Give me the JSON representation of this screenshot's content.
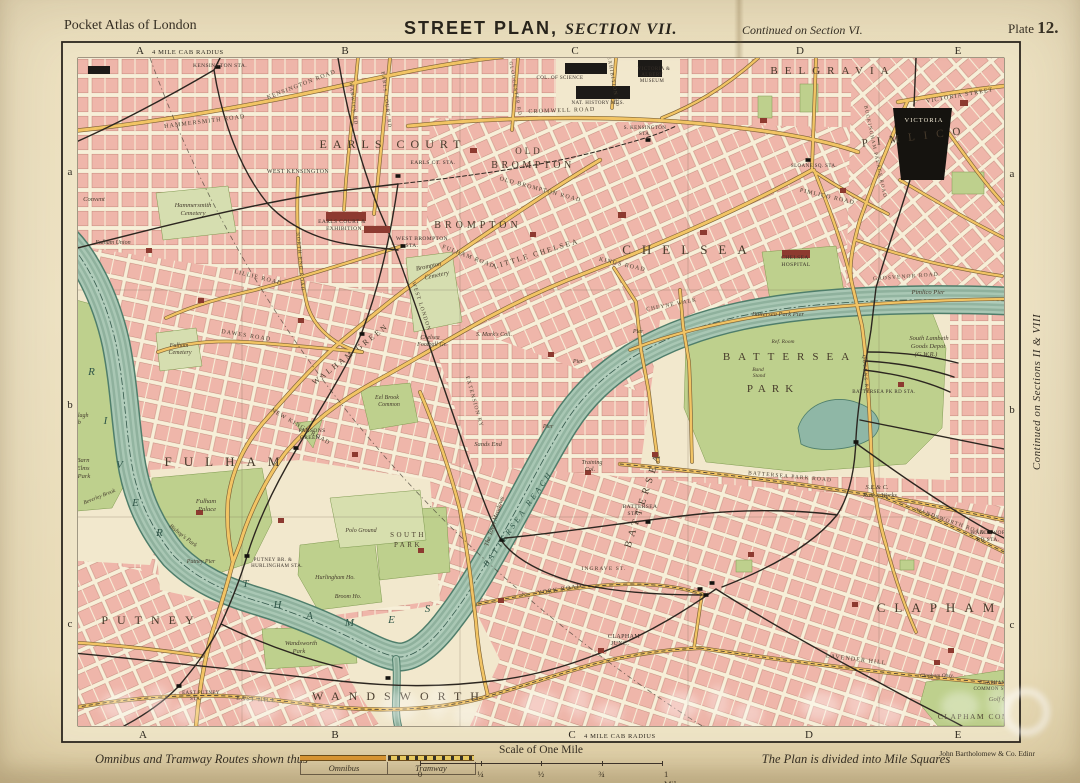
{
  "header": {
    "left": "Pocket Atlas of London",
    "title": "STREET PLAN,",
    "section": "SECTION VII.",
    "continued": "Continued on Section VI.",
    "plate_word": "Plate",
    "plate_num": "12."
  },
  "margins": {
    "cab_top": "4 MILE CAB RADIUS",
    "cab_bottom": "4 MILE CAB RADIUS",
    "top": [
      {
        "t": "A",
        "x": 140
      },
      {
        "t": "B",
        "x": 345
      },
      {
        "t": "C",
        "x": 575
      },
      {
        "t": "D",
        "x": 800
      },
      {
        "t": "E",
        "x": 958
      }
    ],
    "bottom": [
      {
        "t": "A",
        "x": 143
      },
      {
        "t": "B",
        "x": 335
      },
      {
        "t": "C",
        "x": 572
      },
      {
        "t": "D",
        "x": 809
      },
      {
        "t": "E",
        "x": 958
      }
    ],
    "left": [
      {
        "t": "a",
        "y": 175
      },
      {
        "t": "b",
        "y": 408
      },
      {
        "t": "c",
        "y": 627
      }
    ],
    "right": [
      {
        "t": "a",
        "y": 177
      },
      {
        "t": "b",
        "y": 413
      },
      {
        "t": "c",
        "y": 628
      }
    ],
    "right_note": "Continued on Sections II & VIII"
  },
  "footer": {
    "routes": "Omnibus and Tramway Routes shown thus",
    "omnibus": "Omnibus",
    "tramway": "Tramway",
    "scale_title": "Scale of One Mile",
    "ticks": [
      "0",
      "¼",
      "½",
      "¾",
      "1 Mile"
    ],
    "note": "The Plan is divided into Mile Squares",
    "publisher": "John Bartholomew & Co. Edinr"
  },
  "map": {
    "labels": [
      {
        "t": "EARLS COURT",
        "x": 393,
        "y": 148,
        "c": "d2",
        "s": 12,
        "ls": 6
      },
      {
        "t": "OLD",
        "x": 529,
        "y": 154,
        "c": "d2",
        "s": 9,
        "ls": 3
      },
      {
        "t": "BROMPTON",
        "x": 533,
        "y": 168,
        "c": "d2",
        "s": 10,
        "ls": 3.5
      },
      {
        "t": "BROMPTON",
        "x": 478,
        "y": 228,
        "c": "d2",
        "s": 10,
        "ls": 4
      },
      {
        "t": "LITTLE CHELSEA",
        "x": 537,
        "y": 256,
        "c": "d3",
        "r": -17,
        "s": 7.5,
        "ls": 2
      },
      {
        "t": "CHELSEA",
        "x": 690,
        "y": 254,
        "c": "d1",
        "s": 13,
        "ls": 11
      },
      {
        "t": "BELGRAVIA",
        "x": 833,
        "y": 74,
        "c": "d2",
        "s": 11,
        "ls": 7
      },
      {
        "t": "PIMLICO",
        "x": 916,
        "y": 140,
        "c": "d2",
        "r": -7,
        "s": 11,
        "ls": 9
      },
      {
        "t": "WALHAM GREEN",
        "x": 352,
        "y": 356,
        "c": "d3",
        "r": -38,
        "s": 8,
        "ls": 2.5
      },
      {
        "t": "FULHAM",
        "x": 228,
        "y": 466,
        "c": "d1",
        "s": 13,
        "ls": 12
      },
      {
        "t": "PUTNEY",
        "x": 152,
        "y": 624,
        "c": "d1",
        "s": 12,
        "ls": 9
      },
      {
        "t": "WANDSWORTH",
        "x": 400,
        "y": 700,
        "c": "d1",
        "s": 12,
        "ls": 9
      },
      {
        "t": "BATTERSEA",
        "x": 646,
        "y": 500,
        "c": "d2",
        "r": -72,
        "s": 10,
        "ls": 5
      },
      {
        "t": "CLAPHAM",
        "x": 940,
        "y": 612,
        "c": "d1",
        "s": 13,
        "ls": 9
      },
      {
        "t": "BATTERSEA",
        "x": 790,
        "y": 360,
        "c": "d2",
        "s": 11,
        "ls": 8
      },
      {
        "t": "PARK",
        "x": 773,
        "y": 392,
        "c": "d2",
        "s": 11,
        "ls": 6
      },
      {
        "t": "SOUTH",
        "x": 408,
        "y": 537,
        "c": "d3",
        "s": 7
      },
      {
        "t": "PARK",
        "x": 408,
        "y": 547,
        "c": "d3",
        "s": 7
      },
      {
        "t": "CLAPHAM COMMON",
        "x": 985,
        "y": 719,
        "c": "d3",
        "s": 7.5,
        "ls": 1.5
      },
      {
        "t": "HAMMERSMITH ROAD",
        "x": 205,
        "y": 123,
        "c": "rd",
        "r": -7
      },
      {
        "t": "KENSINGTON ROAD",
        "x": 302,
        "y": 86,
        "c": "rd",
        "r": -21
      },
      {
        "t": "CROMWELL ROAD",
        "x": 562,
        "y": 112,
        "c": "rd",
        "r": -2
      },
      {
        "t": "OLD BROMPTON ROAD",
        "x": 540,
        "y": 191,
        "c": "rd",
        "r": 15
      },
      {
        "t": "FULHAM ROAD",
        "x": 468,
        "y": 258,
        "c": "rd",
        "r": 21
      },
      {
        "t": "KINGS ROAD",
        "x": 622,
        "y": 266,
        "c": "rd",
        "r": 13
      },
      {
        "t": "NEW KINGS ROAD",
        "x": 300,
        "y": 428,
        "c": "rd",
        "r": 30
      },
      {
        "t": "DAWES ROAD",
        "x": 246,
        "y": 337,
        "c": "rd",
        "r": 9
      },
      {
        "t": "LILLIE ROAD",
        "x": 258,
        "y": 279,
        "c": "rd",
        "r": 14
      },
      {
        "t": "CHEYNE WALK",
        "x": 672,
        "y": 306,
        "c": "rd",
        "r": -11,
        "s": 5.5
      },
      {
        "t": "VICTORIA STREET",
        "x": 960,
        "y": 97,
        "c": "rd",
        "r": -10
      },
      {
        "t": "BUCKINGHAM PALACE ROAD",
        "x": 874,
        "y": 152,
        "c": "rd",
        "r": 78,
        "s": 5
      },
      {
        "t": "PIMLICO ROAD",
        "x": 827,
        "y": 198,
        "c": "rd",
        "r": 13
      },
      {
        "t": "GROSVENOR ROAD",
        "x": 906,
        "y": 278,
        "c": "rd",
        "r": -4,
        "s": 5.5
      },
      {
        "t": "BATTERSEA PARK ROAD",
        "x": 790,
        "y": 478,
        "c": "rd",
        "r": 5,
        "s": 5.5
      },
      {
        "t": "INGRAVE ST.",
        "x": 604,
        "y": 570,
        "c": "rd",
        "s": 5.5
      },
      {
        "t": "LAVENDER HILL",
        "x": 856,
        "y": 661,
        "c": "rd",
        "r": 7
      },
      {
        "t": "YORK ROAD",
        "x": 560,
        "y": 591,
        "c": "rd",
        "r": -9
      },
      {
        "t": "WANDSWORTH ROAD",
        "x": 950,
        "y": 523,
        "c": "rd",
        "r": 19,
        "s": 5.5
      },
      {
        "t": "EARLS COURT RD",
        "x": 385,
        "y": 100,
        "c": "rd",
        "r": 83,
        "s": 5
      },
      {
        "t": "WARWICK RD",
        "x": 352,
        "y": 104,
        "c": "rd",
        "r": 83,
        "s": 5
      },
      {
        "t": "NORTH END ROAD",
        "x": 299,
        "y": 262,
        "c": "rd",
        "r": 85,
        "s": 5
      },
      {
        "t": "GLOUCESTER RD",
        "x": 514,
        "y": 89,
        "c": "rd",
        "r": 80,
        "s": 5
      },
      {
        "t": "EXHIBITION RD",
        "x": 612,
        "y": 82,
        "c": "rd",
        "r": 80,
        "s": 5
      },
      {
        "t": "QUEENS RD",
        "x": 864,
        "y": 374,
        "c": "rd",
        "r": 85,
        "s": 5
      },
      {
        "t": "EAST HILL",
        "x": 256,
        "y": 701,
        "c": "rd",
        "r": 4
      },
      {
        "t": "WEST LONDON",
        "x": 420,
        "y": 307,
        "c": "rd",
        "r": 72,
        "s": 5.5
      },
      {
        "t": "EXTENSION RY",
        "x": 473,
        "y": 402,
        "c": "rd",
        "r": 74,
        "s": 5.5
      },
      {
        "t": "R",
        "x": 92,
        "y": 375,
        "c": "rv"
      },
      {
        "t": "I",
        "x": 106,
        "y": 424,
        "c": "rv"
      },
      {
        "t": "V",
        "x": 120,
        "y": 468,
        "c": "rv"
      },
      {
        "t": "E",
        "x": 136,
        "y": 506,
        "c": "rv"
      },
      {
        "t": "R",
        "x": 160,
        "y": 536,
        "c": "rv"
      },
      {
        "t": "T",
        "x": 246,
        "y": 587,
        "c": "rv"
      },
      {
        "t": "H",
        "x": 278,
        "y": 608,
        "c": "rv"
      },
      {
        "t": "A",
        "x": 310,
        "y": 619,
        "c": "rv"
      },
      {
        "t": "M",
        "x": 350,
        "y": 626,
        "c": "rv"
      },
      {
        "t": "E",
        "x": 392,
        "y": 623,
        "c": "rv"
      },
      {
        "t": "S",
        "x": 428,
        "y": 612,
        "c": "rv"
      },
      {
        "t": "BATTERSEA REACH",
        "x": 520,
        "y": 520,
        "c": "rv",
        "r": -55,
        "s": 8,
        "ls": 3
      },
      {
        "t": "The Town Meadows",
        "x": 496,
        "y": 522,
        "c": "pl",
        "r": -72,
        "s": 6.5
      },
      {
        "t": "Pimlico Pier",
        "x": 928,
        "y": 294,
        "c": "pl"
      },
      {
        "t": "Battersea Park Pier",
        "x": 778,
        "y": 316,
        "c": "pl"
      },
      {
        "t": "Putney Pier",
        "x": 201,
        "y": 563,
        "c": "pl",
        "s": 6
      },
      {
        "t": "Pier",
        "x": 638,
        "y": 333,
        "c": "pl",
        "s": 6
      },
      {
        "t": "Pier",
        "x": 578,
        "y": 363,
        "c": "pl",
        "s": 6
      },
      {
        "t": "Pier",
        "x": 548,
        "y": 428,
        "c": "pl",
        "s": 6
      },
      {
        "t": "KENSINGTON STA.",
        "x": 220,
        "y": 67,
        "c": "st"
      },
      {
        "t": "WEST KENSINGTON",
        "x": 298,
        "y": 173,
        "c": "st",
        "s": 6
      },
      {
        "t": "EARLS COURT &",
        "x": 342,
        "y": 223,
        "c": "st"
      },
      {
        "t": "EXHIBITION",
        "x": 344,
        "y": 230,
        "c": "st"
      },
      {
        "t": "EARLS CT. STA.",
        "x": 433,
        "y": 164,
        "c": "st"
      },
      {
        "t": "WEST BROMPTON",
        "x": 422,
        "y": 240,
        "c": "st"
      },
      {
        "t": "STA.",
        "x": 412,
        "y": 247,
        "c": "st"
      },
      {
        "t": "Brompton",
        "x": 429,
        "y": 268,
        "c": "pl",
        "r": -12
      },
      {
        "t": "Cemetery",
        "x": 437,
        "y": 277,
        "c": "pl",
        "r": -12
      },
      {
        "t": "Hammersmith",
        "x": 193,
        "y": 207,
        "c": "pl"
      },
      {
        "t": "Cemetery",
        "x": 193,
        "y": 215,
        "c": "pl"
      },
      {
        "t": "Convent",
        "x": 94,
        "y": 201,
        "c": "pl"
      },
      {
        "t": "Fulham Union",
        "x": 113,
        "y": 244,
        "c": "pl",
        "s": 6
      },
      {
        "t": "Fulham",
        "x": 179,
        "y": 347,
        "c": "pl",
        "s": 6
      },
      {
        "t": "Cemetery",
        "x": 180,
        "y": 354,
        "c": "pl",
        "s": 6
      },
      {
        "t": "Eel Brook",
        "x": 387,
        "y": 399,
        "c": "pl",
        "s": 6
      },
      {
        "t": "Common",
        "x": 389,
        "y": 406,
        "c": "pl",
        "s": 6
      },
      {
        "t": "PARSONS",
        "x": 312,
        "y": 432,
        "c": "st"
      },
      {
        "t": "GREEN",
        "x": 310,
        "y": 439,
        "c": "st"
      },
      {
        "t": "Sands End",
        "x": 488,
        "y": 446,
        "c": "pl"
      },
      {
        "t": "Chelsea",
        "x": 430,
        "y": 339,
        "c": "pl",
        "s": 6
      },
      {
        "t": "Football Gr.",
        "x": 432,
        "y": 346,
        "c": "pl",
        "s": 6
      },
      {
        "t": "S. Mark's Coll.",
        "x": 494,
        "y": 336,
        "c": "pl",
        "s": 6
      },
      {
        "t": "CHELSEA",
        "x": 795,
        "y": 259,
        "c": "st"
      },
      {
        "t": "HOSPITAL",
        "x": 796,
        "y": 266,
        "c": "st"
      },
      {
        "t": "South Lambeth",
        "x": 929,
        "y": 340,
        "c": "pl"
      },
      {
        "t": "Goods Depot",
        "x": 928,
        "y": 348,
        "c": "pl"
      },
      {
        "t": "(G.W.R.)",
        "x": 926,
        "y": 356,
        "c": "pl"
      },
      {
        "t": "Ref. Room",
        "x": 783,
        "y": 343,
        "c": "pl",
        "s": 5.5
      },
      {
        "t": "Band",
        "x": 758,
        "y": 371,
        "c": "pl",
        "s": 5.5
      },
      {
        "t": "Stand",
        "x": 759,
        "y": 377,
        "c": "pl",
        "s": 5.5
      },
      {
        "t": "BATTERSEA PK RD STA.",
        "x": 884,
        "y": 393,
        "c": "st",
        "s": 5
      },
      {
        "t": "Training",
        "x": 592,
        "y": 464,
        "c": "pl",
        "s": 6
      },
      {
        "t": "Col.",
        "x": 590,
        "y": 471,
        "c": "pl",
        "s": 6
      },
      {
        "t": "BATTERSEA",
        "x": 640,
        "y": 508,
        "c": "st"
      },
      {
        "t": "STA.",
        "x": 634,
        "y": 515,
        "c": "st"
      },
      {
        "t": "CLAPHAM",
        "x": 624,
        "y": 638,
        "c": "st",
        "s": 6
      },
      {
        "t": "JUNC.",
        "x": 620,
        "y": 645,
        "c": "st",
        "s": 6
      },
      {
        "t": "S.E.& C.",
        "x": 877,
        "y": 489,
        "c": "pl"
      },
      {
        "t": "Railw. Works",
        "x": 880,
        "y": 497,
        "c": "pl"
      },
      {
        "t": "WANDSWORTH",
        "x": 992,
        "y": 534,
        "c": "st"
      },
      {
        "t": "RD STA.",
        "x": 988,
        "y": 541,
        "c": "st"
      },
      {
        "t": "Wandsworth",
        "x": 301,
        "y": 645,
        "c": "pl"
      },
      {
        "t": "Park",
        "x": 299,
        "y": 653,
        "c": "pl"
      },
      {
        "t": "Fulham",
        "x": 206,
        "y": 503,
        "c": "pl"
      },
      {
        "t": "Palace",
        "x": 207,
        "y": 511,
        "c": "pl"
      },
      {
        "t": "Bishop's Park",
        "x": 182,
        "y": 537,
        "c": "pl",
        "r": 38,
        "s": 6
      },
      {
        "t": "Polo Ground",
        "x": 361,
        "y": 532,
        "c": "pl",
        "s": 6
      },
      {
        "t": "Hurlingham Ho.",
        "x": 335,
        "y": 579,
        "c": "pl",
        "s": 6
      },
      {
        "t": "Broom Ho.",
        "x": 348,
        "y": 598,
        "c": "pl",
        "s": 6
      },
      {
        "t": "Barn",
        "x": 83,
        "y": 462,
        "c": "pl"
      },
      {
        "t": "Elms",
        "x": 83,
        "y": 470,
        "c": "pl"
      },
      {
        "t": "Park",
        "x": 84,
        "y": 478,
        "c": "pl"
      },
      {
        "t": "Ranelagh",
        "x": 77,
        "y": 417,
        "c": "pl",
        "s": 6
      },
      {
        "t": "Club",
        "x": 75,
        "y": 424,
        "c": "pl",
        "s": 6
      },
      {
        "t": "Beverley Brook",
        "x": 100,
        "y": 498,
        "c": "pl",
        "r": -22,
        "s": 5.5
      },
      {
        "t": "PUTNEY BR. &",
        "x": 273,
        "y": 561,
        "c": "st",
        "s": 5
      },
      {
        "t": "HURLINGHAM STA.",
        "x": 277,
        "y": 567,
        "c": "st",
        "s": 5
      },
      {
        "t": "EAST PUTNEY",
        "x": 201,
        "y": 694,
        "c": "st",
        "s": 5
      },
      {
        "t": "STA.",
        "x": 196,
        "y": 700,
        "c": "st",
        "s": 5
      },
      {
        "t": "Golf Co.",
        "x": 1000,
        "y": 701,
        "c": "pl",
        "s": 6.5
      },
      {
        "t": "Clapham Obsy.",
        "x": 937,
        "y": 677,
        "c": "pl",
        "s": 5.5
      },
      {
        "t": "CLAPHAM",
        "x": 993,
        "y": 684,
        "c": "st",
        "s": 5
      },
      {
        "t": "COMMON STA.",
        "x": 993,
        "y": 690,
        "c": "st",
        "s": 5
      },
      {
        "t": "VICTORIA",
        "x": 924,
        "y": 122,
        "c": "wh"
      },
      {
        "t": "VICTORIA &",
        "x": 654,
        "y": 70,
        "c": "st",
        "s": 5
      },
      {
        "t": "ALBERT",
        "x": 652,
        "y": 76,
        "c": "st",
        "s": 5
      },
      {
        "t": "MUSEUM",
        "x": 652,
        "y": 82,
        "c": "st",
        "s": 5
      },
      {
        "t": "NAT. HISTORY MUS.",
        "x": 598,
        "y": 104,
        "c": "st",
        "s": 5
      },
      {
        "t": "COL. OF SCIENCE",
        "x": 560,
        "y": 79,
        "c": "st",
        "s": 5
      },
      {
        "t": "S. KENSINGTON",
        "x": 645,
        "y": 129,
        "c": "st",
        "s": 5
      },
      {
        "t": "STA.",
        "x": 645,
        "y": 135,
        "c": "st",
        "s": 5
      },
      {
        "t": "SLOANE SQ. STA.",
        "x": 814,
        "y": 167,
        "c": "st",
        "s": 5
      }
    ]
  }
}
